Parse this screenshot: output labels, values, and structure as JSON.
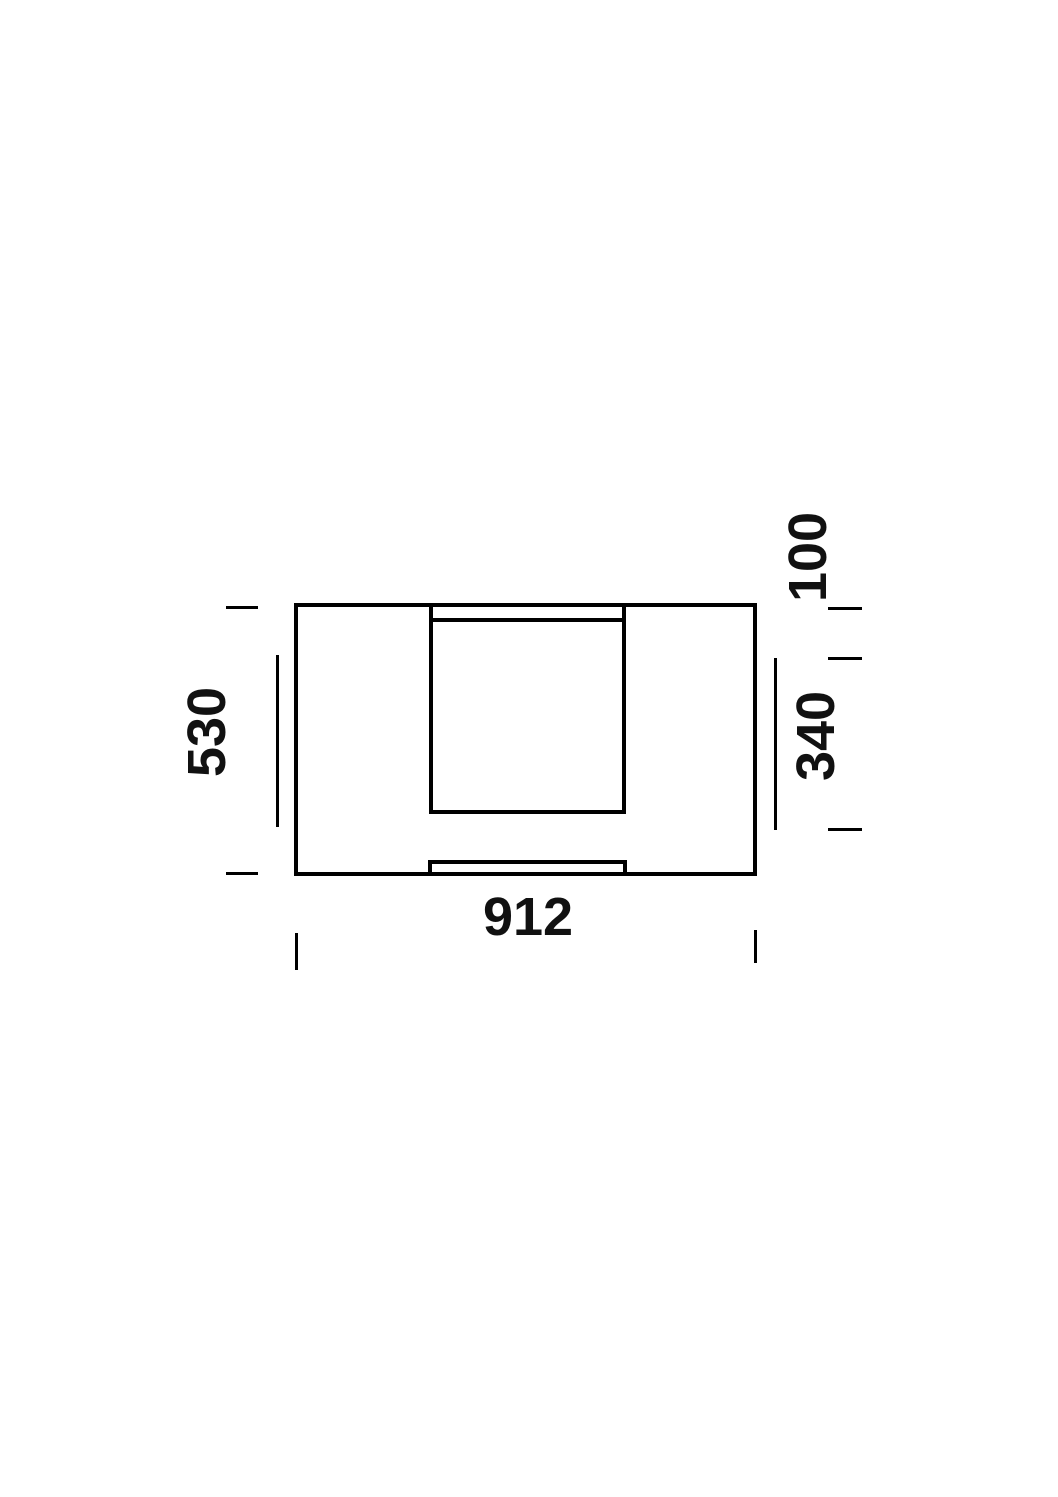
{
  "drawing": {
    "description_labels": {
      "left_height": "530",
      "right_top_offset": "100",
      "right_opening_height": "340",
      "bottom_width": "912"
    },
    "colors": {
      "line": "#000000",
      "text": "#111111",
      "background": "#ffffff"
    }
  }
}
